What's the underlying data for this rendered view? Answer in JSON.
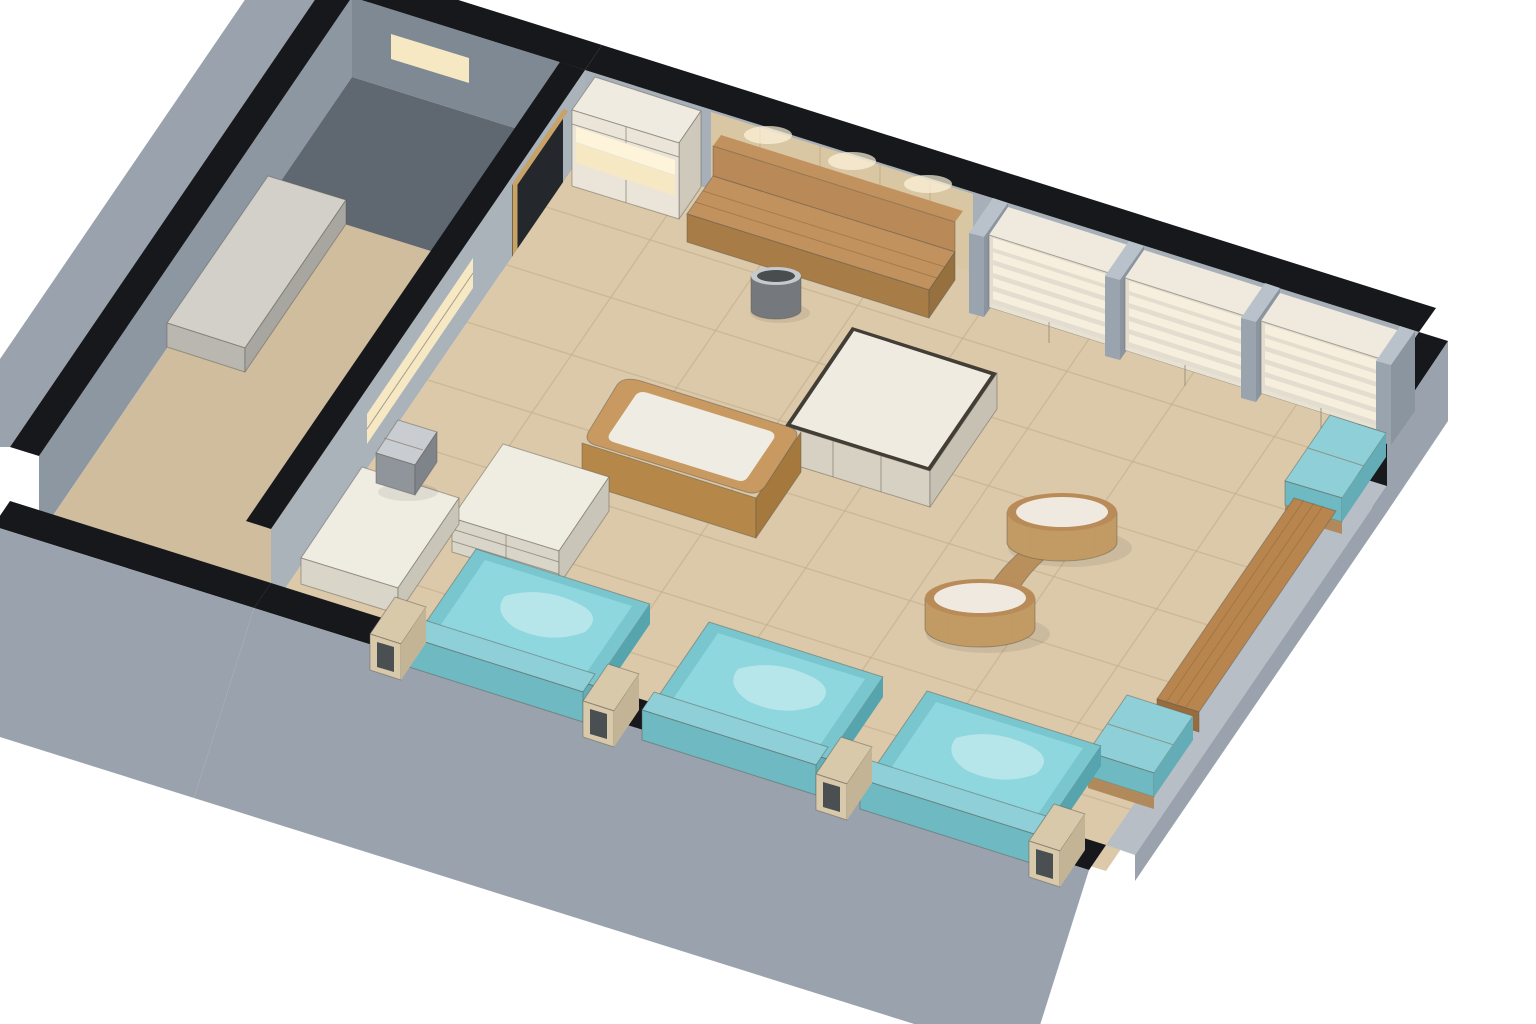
{
  "scene": {
    "description": "3D isometric cutaway rendering of a spa foot-bath lounge with gray concrete walls, black wall caps, beige tiled floor, a curved oak reception desk, backlit display shelving and three turquoise foot-bath tubs along the cut-away front wall",
    "style": "architectural watercolor render",
    "view": "isometric dollhouse cutaway",
    "background": "#ffffff"
  },
  "dimensions": {
    "width": 1536,
    "height": 1024
  },
  "palette": {
    "bg": "#ffffff",
    "cap": "#17181b",
    "concrete": "#a7afb8",
    "concrete_dim": "#8d97a2",
    "concrete_dark": "#7f8994",
    "partition": "#aab2ba",
    "dark_zone": "#5f6771",
    "exterior": "#9aa3ad",
    "lowwall_cap": "#b7bec6",
    "alcove": "#17191c",
    "doorway": "#24272b",
    "door_frame": "#c9a265",
    "floor": "#dbc9a9",
    "floor_dim": "#cfbd9e",
    "glow": "#f6e8c3",
    "glow_bright": "#fdf4da",
    "panel_wood": "#d9c7a3",
    "stone_top": "#d2d0c9",
    "stone_front": "#b9b7b0",
    "stone_side": "#a8a6a0",
    "cab_front": "#eae5d8",
    "cab_side": "#cfc9bc",
    "cab_top": "#f0ebe0",
    "case_frame": "#e3ddd0",
    "case_lit": "#f7efdd",
    "case_cab": "#e8e2d5",
    "case_side": "#c9c3b6",
    "case_top": "#efeadd",
    "pillar_front": "#9aa4ae",
    "pillar_side": "#8b95a0",
    "pillar_top": "#b9c2cb",
    "wood_back": "#b98a57",
    "wood_seat": "#c2925e",
    "wood_seat_front": "#a87c46",
    "wood_seat_side": "#96703e",
    "metal_body": "#75797d",
    "metal_top": "#c6c9cd",
    "metal_inner": "#4a4d50",
    "metal2_top": "#c9cdd1",
    "metal2_front": "#8f959a",
    "metal2_side": "#7e848a",
    "marble": "#f0ebe1",
    "island_front": "#d7d1c3",
    "island_side": "#c7c1b3",
    "island_rim": "#423d35",
    "table_rim": "#b98b58",
    "table_marble": "#efe9df",
    "table_body": "#c29a63",
    "table_conn": "#b9905c",
    "desk_top": "#c89a62",
    "desk_front": "#b58849",
    "desk_side": "#a5793d",
    "desk_inner": "#efece3",
    "white_top": "#efece2",
    "white_front": "#d9d6c9",
    "white_side": "#c9c6b9",
    "tub_rim": "#79c6cf",
    "water": "#8fd7de",
    "water_hi": "#c8ecef",
    "tub_front": "#5fb0ba",
    "tub_side": "#55a4ae",
    "cushion": "#8fd0d8",
    "cushion_front": "#6fb9c2",
    "cushion_side": "#65adb6",
    "wood_base": "#b08a5a",
    "plank": "#b9854e",
    "plank_front": "#9a6c3c",
    "frame_tan": "#d9c9ab",
    "frame_side": "#c4b496",
    "frame_hole": "#4a4f52"
  },
  "inventory": [
    {
      "id": "reception-desk",
      "label": "Curved oak reception desk with white counter channel",
      "qty": 1
    },
    {
      "id": "center-island",
      "label": "Marble-top island counter with dark rim",
      "qty": 1
    },
    {
      "id": "round-table",
      "label": "Oak drum side table with white marble top",
      "qty": 2
    },
    {
      "id": "foot-bath-tub",
      "label": "Foot-bath tub with turquoise water and cushioned backrest",
      "qty": 3
    },
    {
      "id": "partition-frame",
      "label": "Light-wood open partition frame between tubs",
      "qty": 4
    },
    {
      "id": "display-case",
      "label": "Backlit display case with four lit shelves and base cabinet",
      "qty": 3
    },
    {
      "id": "tall-cabinet",
      "label": "Tall linen cabinet with lit towel niches",
      "qty": 1
    },
    {
      "id": "wall-bench",
      "label": "Oak bench with backrest panel on wood-paneled wall",
      "qty": 1
    },
    {
      "id": "right-wall-bench",
      "label": "Plank bench along right wall",
      "qty": 1
    },
    {
      "id": "cushion-bench",
      "label": "Teal cushioned bench on wood base",
      "qty": 3
    },
    {
      "id": "stone-bench",
      "label": "Stone bench in side corridor",
      "qty": 1
    },
    {
      "id": "lounge-seat",
      "label": "White upholstered chaise seat",
      "qty": 1
    },
    {
      "id": "storage-cabinet",
      "label": "White drawer cabinet",
      "qty": 1
    },
    {
      "id": "trash-bin",
      "label": "Stainless-steel waste bin",
      "qty": 2
    },
    {
      "id": "doorway",
      "label": "Dark door opening",
      "qty": 2
    },
    {
      "id": "lit-niche",
      "label": "Recessed warm-lit wall niche",
      "qty": 3
    }
  ]
}
